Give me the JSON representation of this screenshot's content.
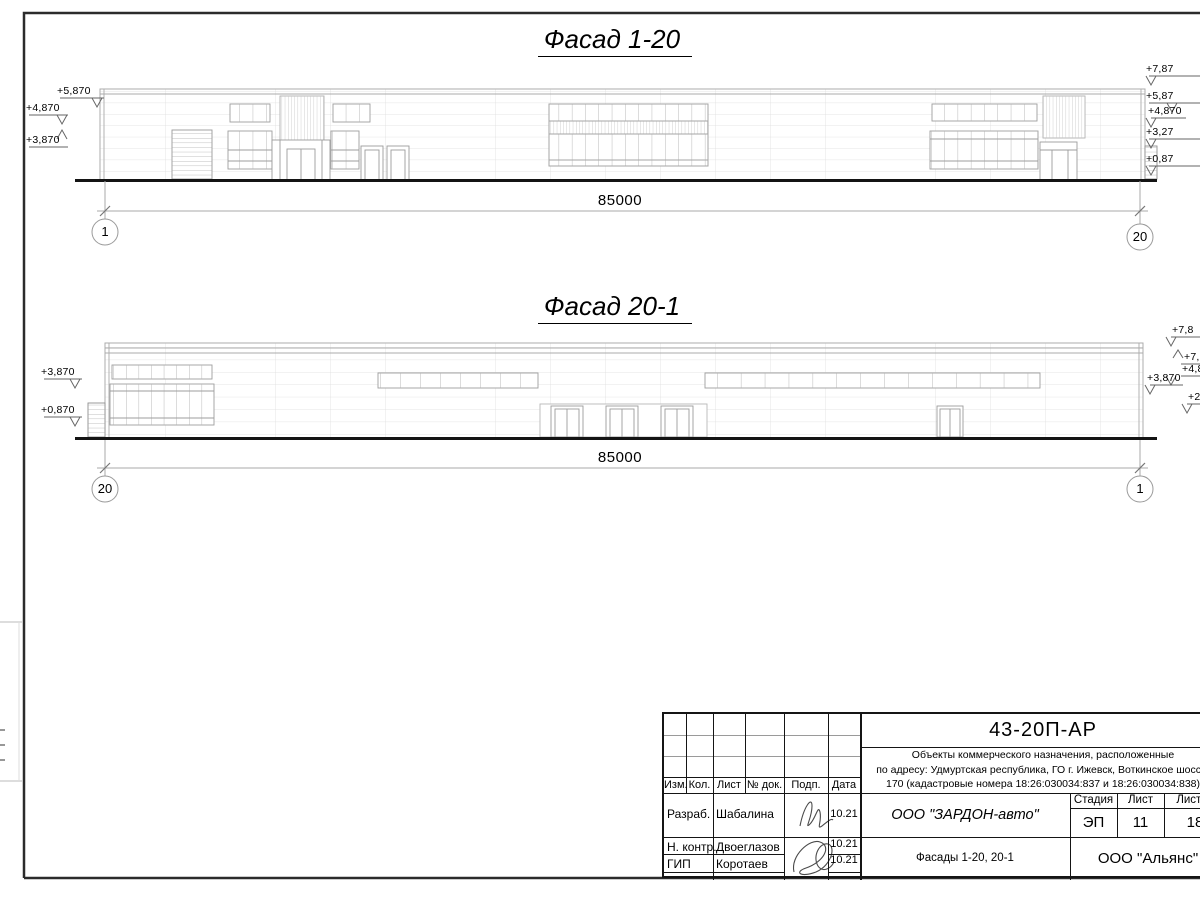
{
  "facade1": {
    "title": "Фасад 1-20",
    "dimension": "85000",
    "axis_left": "1",
    "axis_right": "20",
    "marks_left": [
      "+5,870",
      "+4,870",
      "+3,870"
    ],
    "marks_right": [
      "+7,87",
      "+5,87",
      "+4,870",
      "+3,27",
      "+0,87"
    ]
  },
  "facade2": {
    "title": "Фасад 20-1",
    "dimension": "85000",
    "axis_left": "20",
    "axis_right": "1",
    "marks_left": [
      "+3,870",
      "+0,870"
    ],
    "marks_right": [
      "+7,8",
      "+7,",
      "+4,8",
      "+3,870",
      "+2,1"
    ]
  },
  "titleblock": {
    "code": "43-20П-АР",
    "project": {
      "line1": "Объекты коммерческого назначения, расположенные",
      "line2": "по адресу: Удмуртская республика, ГО г. Ижевск, Воткинское шоссе,",
      "line3": "170 (кадастровые номера 18:26:030034:837 и 18:26:030034:838)"
    },
    "columns": {
      "izm": "Изм.",
      "kol": "Кол.",
      "list": "Лист",
      "doc": "№ док.",
      "sign": "Подп.",
      "date": "Дата"
    },
    "rows": [
      {
        "role": "Разраб.",
        "name": "Шабалина",
        "date": "10.21"
      },
      {
        "role": "Н. контр.",
        "name": "Двоеглазов",
        "date": "10.21"
      },
      {
        "role": "ГИП",
        "name": "Коротаев",
        "date": "10.21"
      }
    ],
    "client": "ООО \"ЗАРДОН-авто\"",
    "sheet_name": "Фасады 1-20, 20-1",
    "org": "ООО \"Альянс\"",
    "stage": {
      "label": "Стадия",
      "value": "ЭП"
    },
    "sheet_no": {
      "label": "Лист",
      "value": "11"
    },
    "sheets_total": {
      "label": "Листов",
      "value": "18"
    }
  }
}
